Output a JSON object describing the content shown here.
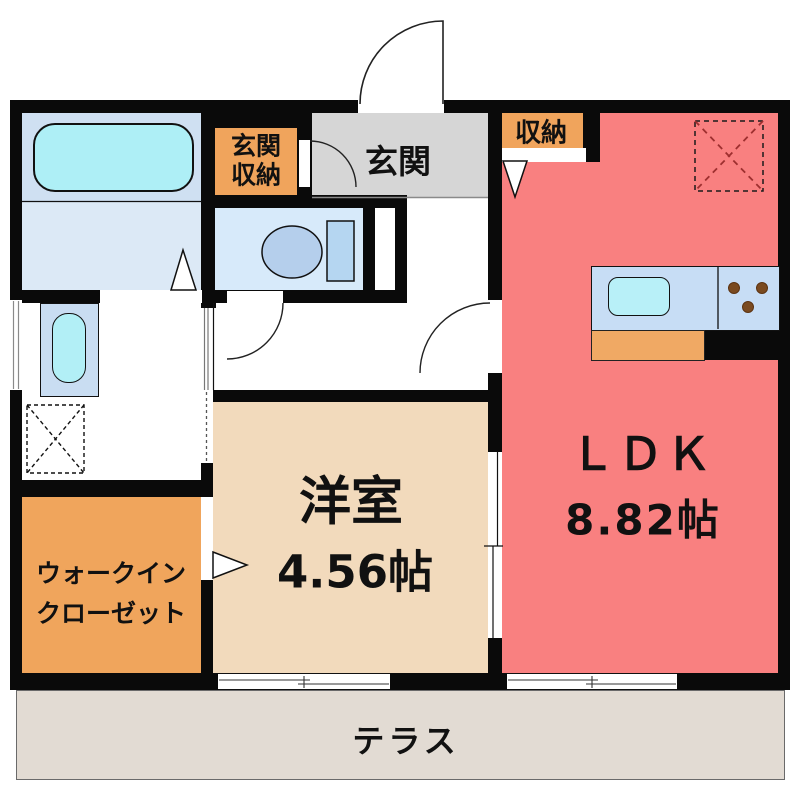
{
  "plan_title": "apartment-floor-plan",
  "rooms": {
    "entrance": {
      "label": "玄関"
    },
    "entrance_storage": {
      "line1": "玄関",
      "line2": "収納"
    },
    "closet": {
      "label": "収納"
    },
    "ldk": {
      "label": "ＬＤＫ",
      "area": "8.82帖"
    },
    "western": {
      "label": "洋室",
      "area": "4.56帖"
    },
    "wic": {
      "line1": "ウォークイン",
      "line2": "クローゼット"
    },
    "terrace": {
      "label": "テラス"
    }
  },
  "fixtures": {
    "bathtub": "bathtub-icon",
    "toilet": "toilet-icon",
    "washbasin": "washbasin-icon",
    "washing_machine_space": "dashed-x-square-icon",
    "kitchen_sink": "sink-icon",
    "stove": "three-burner-dots-icon",
    "ceiling_equipment": "red-dashed-x-square-icon"
  },
  "colors": {
    "wall": "#0a0a0a",
    "ldk_red": "#f98080",
    "western_tan": "#f2dabc",
    "accent_orange": "#f0a45c",
    "entrance_gray": "#d6d6d6",
    "terrace_gray": "#e2dbd3",
    "bath_blue": "#cfe0f2",
    "toilet_blue": "#d7eafa",
    "fixture_cyan": "#aeeff6",
    "counter_blue": "#c7ddf5",
    "dashed_red": "#9e2f2f"
  }
}
